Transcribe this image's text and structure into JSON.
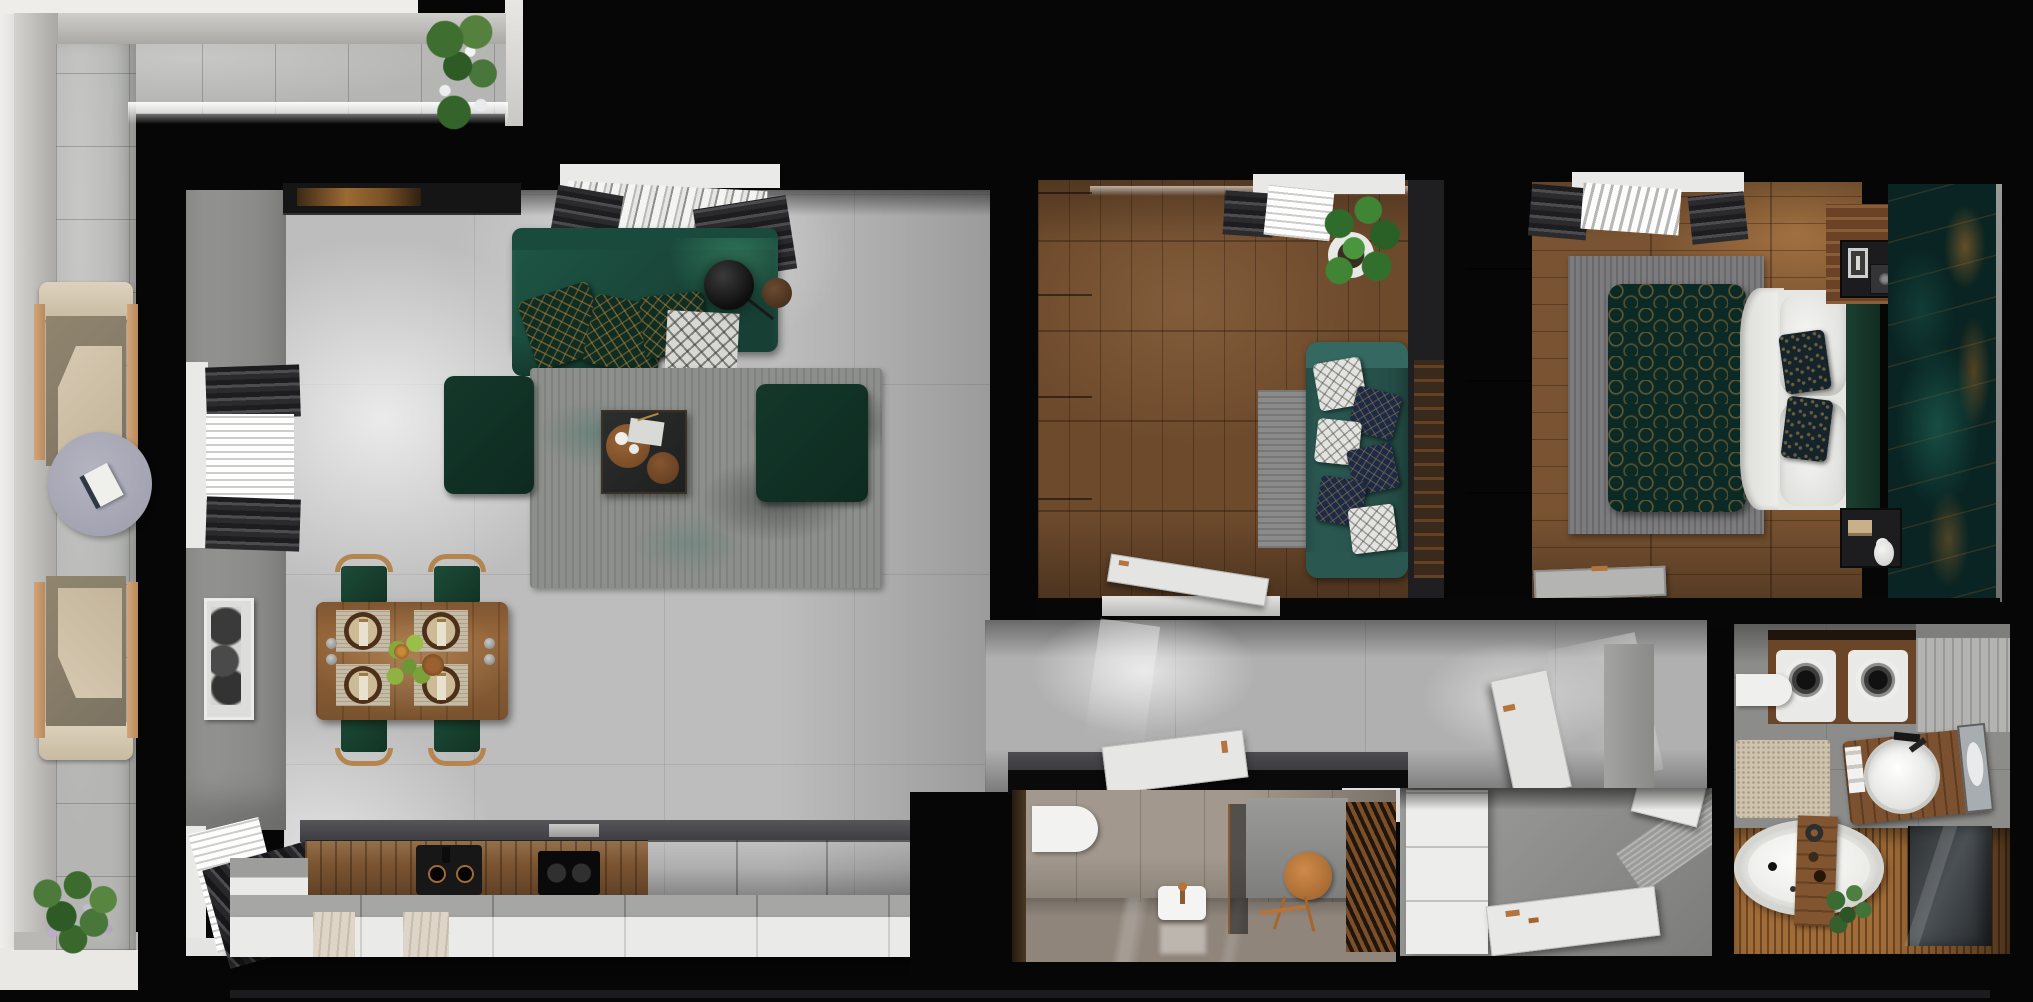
{
  "scene": {
    "kind": "top-down 3D apartment floor-plan render",
    "style": "dark shell walls with emerald green, walnut wood and concrete interior",
    "visible_text": "none"
  },
  "palette": {
    "bg": "#060606",
    "tile": "#b5b6b4",
    "concrete": "#bdbdbd",
    "wallGray": "#8e8e8e",
    "sofaGreen": "#1e5645",
    "poufGreen": "#113126",
    "pillowTeal": "#0f2d23",
    "pillowGold": "#b0823c",
    "rugGray": "#8d8f8c",
    "tableWood": "#96663a",
    "chairWood": "#b5854f",
    "kitchenWood": "#7c5532",
    "islandWhite": "#eaeae8",
    "officeWoodFloor": "#6d4a2c",
    "officeSofaTeal": "#2c5c54",
    "pillowNavy": "#1c2a47",
    "bedroomWoodFloor": "#7a5432",
    "duvetTeal": "#0b2a25",
    "sheetWhite": "#eaeae8",
    "headboardGreen": "#1a3f31",
    "featureWallTeal": "#092422",
    "featureWallGold": "#a5662e",
    "copper": "#b5743c",
    "doorWhite": "#e4e4e2",
    "wcTile": "#a2988d",
    "slatWood": "#7a4f2b",
    "bathWood": "#a06c38",
    "tubWhite": "#e9e9e6",
    "matBeige": "#cfc3ae",
    "machineWood": "#6b4527",
    "grayCabinet": "#b3b3b1",
    "armchairBeige": "#d7cab2",
    "armWood": "#d2a477",
    "plantGreen": "#4d7a3a"
  },
  "rooms": [
    {
      "id": "balcony",
      "label": "balcony terrace",
      "furniture": [
        "lounge chair",
        "lounge chair",
        "round side table with book",
        "flower planter",
        "flowering plant"
      ]
    },
    {
      "id": "living-room",
      "label": "open living / dining / kitchen",
      "furniture": [
        "tv media panel",
        "green sofa with patterned pillows",
        "throw blanket",
        "floor lamp",
        "round side table",
        "area rug",
        "green ottoman",
        "green ottoman",
        "coffee table with trays",
        "potted plant",
        "wall art",
        "dining table with four place settings",
        "dining chair",
        "dining chair",
        "dining chair",
        "dining chair",
        "wood kitchen counter",
        "black sink",
        "induction hob",
        "extractor vent",
        "white kitchen island"
      ]
    },
    {
      "id": "second-room",
      "label": "den / office",
      "furniture": [
        "wardrobe",
        "teal sofa with pillows",
        "area rug",
        "large potted plant",
        "wood art panel",
        "open white door"
      ]
    },
    {
      "id": "bedroom",
      "label": "bedroom",
      "furniture": [
        "wardrobe",
        "double bed with teal patterned duvet",
        "white pillows",
        "accent pillows",
        "green headboard",
        "nightstand with radio and photo frames",
        "speaker",
        "nightstand with books and candle",
        "area rug",
        "serving tray",
        "teal marble feature wall"
      ]
    },
    {
      "id": "hallway",
      "label": "hallway",
      "furniture": [
        "open white door",
        "open white door"
      ]
    },
    {
      "id": "entry",
      "label": "entry nook",
      "furniture": [
        "white wardrobe",
        "white door panel",
        "white door panel"
      ]
    },
    {
      "id": "wc",
      "label": "guest toilet",
      "furniture": [
        "wall-hung toilet",
        "washbasin with copper faucet",
        "round copper mirror",
        "copper valet stand",
        "wood slat wall",
        "glass partition"
      ]
    },
    {
      "id": "bathroom",
      "label": "bathroom / laundry",
      "furniture": [
        "washing machine",
        "tumble dryer",
        "gray storage cabinet",
        "toilet",
        "wood vanity with round basin",
        "mirror",
        "towels",
        "beige bath mat",
        "freestanding oval bathtub",
        "wood bath caddy with shower head",
        "potted plant",
        "dark glass shower screen"
      ]
    }
  ]
}
